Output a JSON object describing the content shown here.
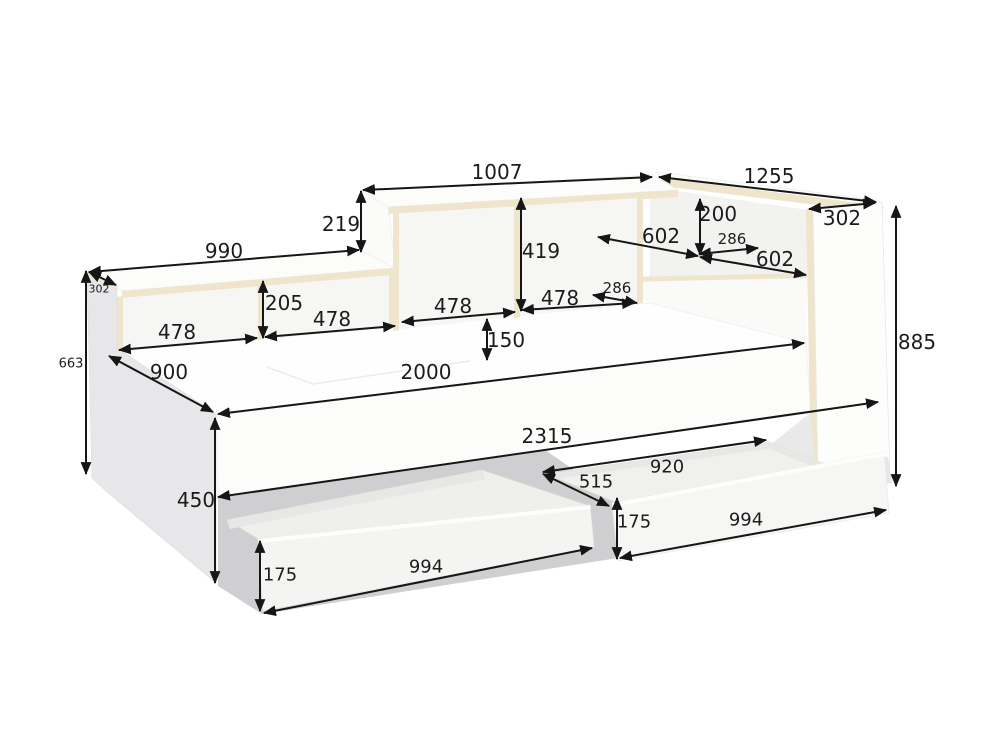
{
  "diagram": {
    "figure_type": "furniture dimension diagram - bed with shelf headboard, head-side storage unit and two pull-out drawers",
    "background_color": "#ffffff",
    "line_color": "#161616",
    "label_color": "#1c1c1c",
    "board_edge_color": "#eee5cc",
    "panel_gray_color": "#e7e7e9",
    "shadow_color": "#cfcfd2",
    "dimensions": [
      {
        "name": "shelf-low-top-length",
        "value": "990",
        "x1": 89,
        "y1": 272,
        "x2": 359,
        "y2": 250,
        "lx": 224,
        "ly": 251,
        "fs": 20
      },
      {
        "name": "shelf-tall-top-length",
        "value": "1007",
        "x1": 363,
        "y1": 190,
        "x2": 652,
        "y2": 177,
        "lx": 497,
        "ly": 172,
        "fs": 20
      },
      {
        "name": "head-unit-length",
        "value": "1255",
        "x1": 659,
        "y1": 177,
        "x2": 876,
        "y2": 202,
        "lx": 769,
        "ly": 176,
        "fs": 20
      },
      {
        "name": "head-unit-top-depth",
        "value": "302",
        "x1": 809,
        "y1": 209,
        "x2": 875,
        "y2": 203,
        "lx": 842,
        "ly": 218,
        "fs": 20
      },
      {
        "name": "side-panel-top-depth",
        "value": "302",
        "x1": 89,
        "y1": 272,
        "x2": 116,
        "y2": 285,
        "lx": 99,
        "ly": 289,
        "fs": 11
      },
      {
        "name": "shelf-step-height",
        "value": "219",
        "x1": 361,
        "y1": 191,
        "x2": 361,
        "y2": 252,
        "lx": 341,
        "ly": 224,
        "fs": 20
      },
      {
        "name": "shelf-low-inner-height",
        "value": "205",
        "x1": 263,
        "y1": 281,
        "x2": 263,
        "y2": 338,
        "lx": 284,
        "ly": 303,
        "fs": 20
      },
      {
        "name": "shelf-tall-inner-height",
        "value": "419",
        "x1": 521,
        "y1": 198,
        "x2": 521,
        "y2": 311,
        "lx": 541,
        "ly": 251,
        "fs": 20
      },
      {
        "name": "head-shelf-inner-height",
        "value": "200",
        "x1": 700,
        "y1": 199,
        "x2": 700,
        "y2": 255,
        "lx": 718,
        "ly": 214,
        "fs": 20
      },
      {
        "name": "head-shelf-opening-left",
        "value": "602",
        "x1": 598,
        "y1": 237,
        "x2": 698,
        "y2": 256,
        "lx": 661,
        "ly": 236,
        "fs": 20
      },
      {
        "name": "head-unit-inner-depth",
        "value": "286",
        "x1": 699,
        "y1": 254,
        "x2": 758,
        "y2": 248,
        "lx": 732,
        "ly": 239,
        "fs": 15
      },
      {
        "name": "head-shelf-opening-right",
        "value": "602",
        "x1": 700,
        "y1": 257,
        "x2": 806,
        "y2": 275,
        "lx": 775,
        "ly": 259,
        "fs": 20
      },
      {
        "name": "shelf-tall-inner-depth",
        "value": "286",
        "x1": 593,
        "y1": 295,
        "x2": 637,
        "y2": 303,
        "lx": 617,
        "ly": 288,
        "fs": 15
      },
      {
        "name": "compartment-width-1",
        "value": "478",
        "x1": 119,
        "y1": 350,
        "x2": 257,
        "y2": 338,
        "lx": 177,
        "ly": 332,
        "fs": 20
      },
      {
        "name": "compartment-width-2",
        "value": "478",
        "x1": 265,
        "y1": 337,
        "x2": 395,
        "y2": 326,
        "lx": 332,
        "ly": 319,
        "fs": 20
      },
      {
        "name": "compartment-width-3",
        "value": "478",
        "x1": 402,
        "y1": 322,
        "x2": 515,
        "y2": 312,
        "lx": 453,
        "ly": 306,
        "fs": 20
      },
      {
        "name": "compartment-width-4",
        "value": "478",
        "x1": 522,
        "y1": 310,
        "x2": 634,
        "y2": 303,
        "lx": 560,
        "ly": 298,
        "fs": 20
      },
      {
        "name": "mattress-recess-depth",
        "value": "150",
        "x1": 487,
        "y1": 319,
        "x2": 487,
        "y2": 360,
        "lx": 506,
        "ly": 340,
        "fs": 20
      },
      {
        "name": "side-panel-height",
        "value": "663",
        "x1": 86,
        "y1": 271,
        "x2": 86,
        "y2": 474,
        "lx": 71,
        "ly": 364,
        "fs": 13
      },
      {
        "name": "bed-end-width",
        "value": "900",
        "x1": 109,
        "y1": 356,
        "x2": 213,
        "y2": 412,
        "lx": 169,
        "ly": 372,
        "fs": 20
      },
      {
        "name": "bed-length",
        "value": "2000",
        "x1": 218,
        "y1": 414,
        "x2": 804,
        "y2": 343,
        "lx": 426,
        "ly": 372,
        "fs": 20
      },
      {
        "name": "head-unit-height",
        "value": "885",
        "x1": 896,
        "y1": 206,
        "x2": 896,
        "y2": 486,
        "lx": 917,
        "ly": 342,
        "fs": 20
      },
      {
        "name": "total-length",
        "value": "2315",
        "x1": 218,
        "y1": 497,
        "x2": 878,
        "y2": 402,
        "lx": 547,
        "ly": 436,
        "fs": 20
      },
      {
        "name": "base-height",
        "value": "450",
        "x1": 215,
        "y1": 418,
        "x2": 215,
        "y2": 583,
        "lx": 196,
        "ly": 500,
        "fs": 20
      },
      {
        "name": "drawer-inner-length",
        "value": "920",
        "x1": 543,
        "y1": 472,
        "x2": 766,
        "y2": 440,
        "lx": 667,
        "ly": 467,
        "fs": 18
      },
      {
        "name": "drawer-inner-width",
        "value": "515",
        "x1": 543,
        "y1": 474,
        "x2": 609,
        "y2": 506,
        "lx": 596,
        "ly": 482,
        "fs": 18
      },
      {
        "name": "drawer-left-front-height",
        "value": "175",
        "x1": 260,
        "y1": 541,
        "x2": 260,
        "y2": 611,
        "lx": 280,
        "ly": 575,
        "fs": 18
      },
      {
        "name": "drawer-left-front-length",
        "value": "994",
        "x1": 264,
        "y1": 613,
        "x2": 592,
        "y2": 548,
        "lx": 426,
        "ly": 567,
        "fs": 18
      },
      {
        "name": "drawer-right-front-height",
        "value": "175",
        "x1": 617,
        "y1": 498,
        "x2": 617,
        "y2": 559,
        "lx": 634,
        "ly": 522,
        "fs": 18
      },
      {
        "name": "drawer-right-front-length",
        "value": "994",
        "x1": 620,
        "y1": 558,
        "x2": 886,
        "y2": 510,
        "lx": 746,
        "ly": 520,
        "fs": 18
      }
    ]
  }
}
